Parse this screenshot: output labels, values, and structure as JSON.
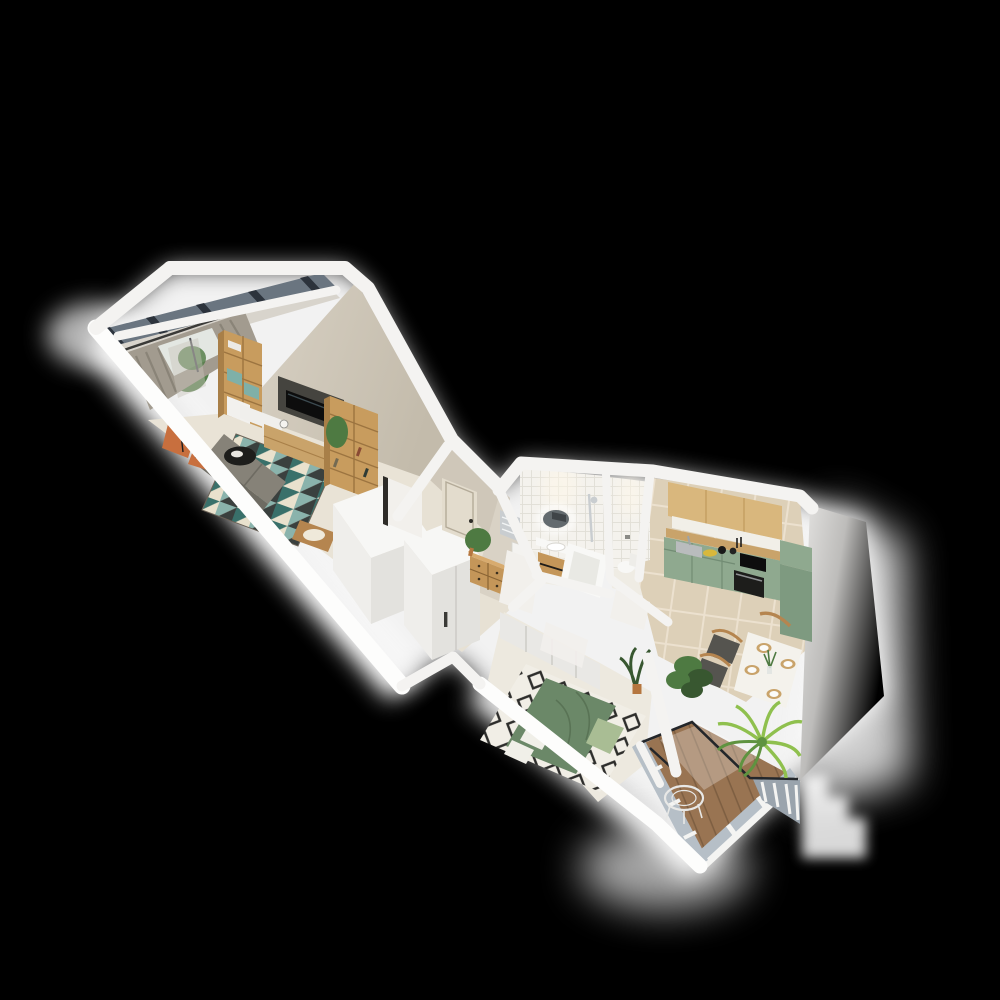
{
  "scene": {
    "title": "3d-apartment-floorplan-render",
    "background": "#000000",
    "rooms": [
      {
        "name": "Loggia",
        "items": [
          "glazed-window-wall",
          "potted-plant",
          "curtain"
        ]
      },
      {
        "name": "Living room",
        "items": [
          "gray-curtains",
          "balcony-door",
          "bookshelf-with-teal-drawers",
          "wall-tv",
          "tv-stand",
          "tall-bookshelf",
          "potted-plant",
          "gray-sofa",
          "orange-lounge-chair",
          "black-floor-lamp",
          "round-coffee-table",
          "teal-geometric-rug",
          "wooden-armchair",
          "white-wardrobe-volume"
        ]
      },
      {
        "name": "Hallway",
        "items": [
          "entrance-door",
          "white-interior-door",
          "white-closet-volume",
          "wooden-dresser",
          "potted-plant"
        ]
      },
      {
        "name": "Bathroom",
        "items": [
          "led-oval-mirror",
          "wood-vanity-sink",
          "bathtub",
          "shower-set",
          "towel-radiator",
          "laundry-cabinet",
          "open-door"
        ]
      },
      {
        "name": "WC",
        "items": [
          "toilet",
          "open-door"
        ]
      },
      {
        "name": "Kitchen",
        "items": [
          "wood-upper-cabinets",
          "tile-backsplash",
          "wood-countertop",
          "steel-sink",
          "black-cooktop",
          "built-in-oven",
          "sage-base-cabinets",
          "tall-green-cabinet",
          "dining-table-four-settings",
          "wood-chairs",
          "vase-with-greenery",
          "fruit-bowl",
          "floor-plants"
        ]
      },
      {
        "name": "Bedroom",
        "items": [
          "bed-green-duvet",
          "diamond-pattern-rug",
          "white-sliding-wardrobe",
          "potted-plants",
          "open-door"
        ]
      },
      {
        "name": "Balcony",
        "items": [
          "glazed-railing-panels",
          "palm-plant",
          "wire-chair",
          "wood-deck"
        ]
      }
    ]
  },
  "palette": {
    "bg": "#000000",
    "glow": "#ffffff",
    "wallWhite": "#f4f3f1",
    "wallLit": "#fdfdfc",
    "wallBeige": "#cfc7b9",
    "wallBeige2": "#d9d2c5",
    "grayWall": "#dddcda",
    "floorLiving": "#e9e3d6",
    "floorHall": "#e7e1d4",
    "floorBedroom": "#ede9df",
    "bathFloor": "#efece4",
    "tileBath": "#f4f2ed",
    "tileBathLine": "#e1ded6",
    "kitchenTile": "#ddd0b8",
    "kitchenTileLine": "#ece1cf",
    "loggiaFloor": "#d8d4cc",
    "woodShelf": "#c89c5e",
    "woodDark": "#a87f48",
    "tealDrawer": "#7fb0a8",
    "tvPanel": "#45443f",
    "tvScreen": "#0d0d0d",
    "sofa": "#868278",
    "sofaDark": "#6e6b62",
    "orange": "#c86f3e",
    "rugCream": "#e9e1cd",
    "rugTealDark": "#39706a",
    "rugTealLight": "#8ab3ac",
    "rugInk": "#3a403e",
    "curtain": "#a29b8f",
    "curtainDark": "#8a8478",
    "sheer": "#c8c4ba",
    "windowLight": "#e3e7e2",
    "loggiaGlass": "#6a7580",
    "loggiaFrame": "#2c333c",
    "boxTop": "#f7f7f5",
    "boxLeft": "#efeeeb",
    "boxRight": "#e3e2de",
    "doorCream": "#e3dccd",
    "doorWhite": "#f2f0ec",
    "doorGap": "#2e2c28",
    "dresser": "#c49659",
    "mirrorGlass": "#636a6e",
    "chrome": "#c9cdd0",
    "fixtureWhite": "#f8f8f6",
    "upperWood": "#d9b77d",
    "counterWood": "#c9a36a",
    "backsplash": "#f1efe8",
    "kitchenGreen": "#8fa98f",
    "kitchenGreenDark": "#7e9a80",
    "ovenBlack": "#1d1d1b",
    "steel": "#b9bcbd",
    "tableWhite": "#f4f2ec",
    "chairWood": "#b5854f",
    "seatDark": "#55544f",
    "bedGreen": "#6b8868",
    "blanket": "#a9bd94",
    "pillow": "#f0efe8",
    "rugBedBase": "#f1eee6",
    "rugBedInk": "#2d2d2b",
    "wardrobe": "#e9e8e5",
    "deck": "#997452",
    "deckLine": "#7e5f42",
    "glassBalcony": "#b6bfc7",
    "glassBalcony2": "#9aa4ad",
    "mullion": "#f4f4f2",
    "rail": "#23262a",
    "palm": "#8fc04e",
    "palmDark": "#5f9340",
    "plant": "#4e7a42",
    "plantDark": "#385730",
    "pot": "#b5763f",
    "fruit": "#d8b83c"
  }
}
